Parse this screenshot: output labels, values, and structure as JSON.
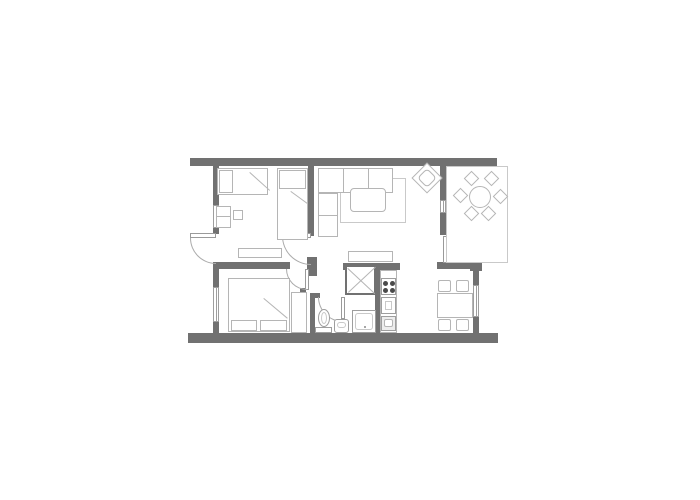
{
  "meta": {
    "type": "architectural-floor-plan",
    "description": "Top-down line drawing of a two-bedroom apartment with balcony; monochrome, no text labels rendered"
  },
  "palette": {
    "background": "#ffffff",
    "wall": "#717171",
    "furniture_outline": "#b5b5b5",
    "fixture_outline": "#9e9e9e",
    "door_arc": "#ababab",
    "stove_burner": "#4a4a4a"
  },
  "rooms": [
    {
      "name": "bedroom-top-left",
      "furniture": [
        "single-bed-horizontal",
        "single-bed-vertical",
        "pillows",
        "desk",
        "stool",
        "low-dresser"
      ]
    },
    {
      "name": "living-room",
      "furniture": [
        "corner-sofa",
        "rug",
        "coffee-table",
        "armchair-rotated",
        "sideboard"
      ]
    },
    {
      "name": "balcony",
      "furniture": [
        "round-table",
        "six-chairs"
      ]
    },
    {
      "name": "bedroom-bottom-left",
      "furniture": [
        "double-bed",
        "two-pillows",
        "wardrobe"
      ]
    },
    {
      "name": "bathroom",
      "furniture": [
        "toilet",
        "washbasin",
        "shower"
      ]
    },
    {
      "name": "kitchen-dining",
      "furniture": [
        "stove-4-burners",
        "oven-unit",
        "kitchen-sink-unit",
        "dining-table",
        "four-chairs"
      ]
    },
    {
      "name": "hall",
      "furniture": [
        "storage-closet-x"
      ]
    }
  ],
  "openings": {
    "window_count": 4,
    "door_count": 5,
    "doors": [
      "exterior-door-left-outward",
      "bedroom-1-door",
      "bedroom-2-door",
      "bathroom-door",
      "balcony-door"
    ]
  }
}
